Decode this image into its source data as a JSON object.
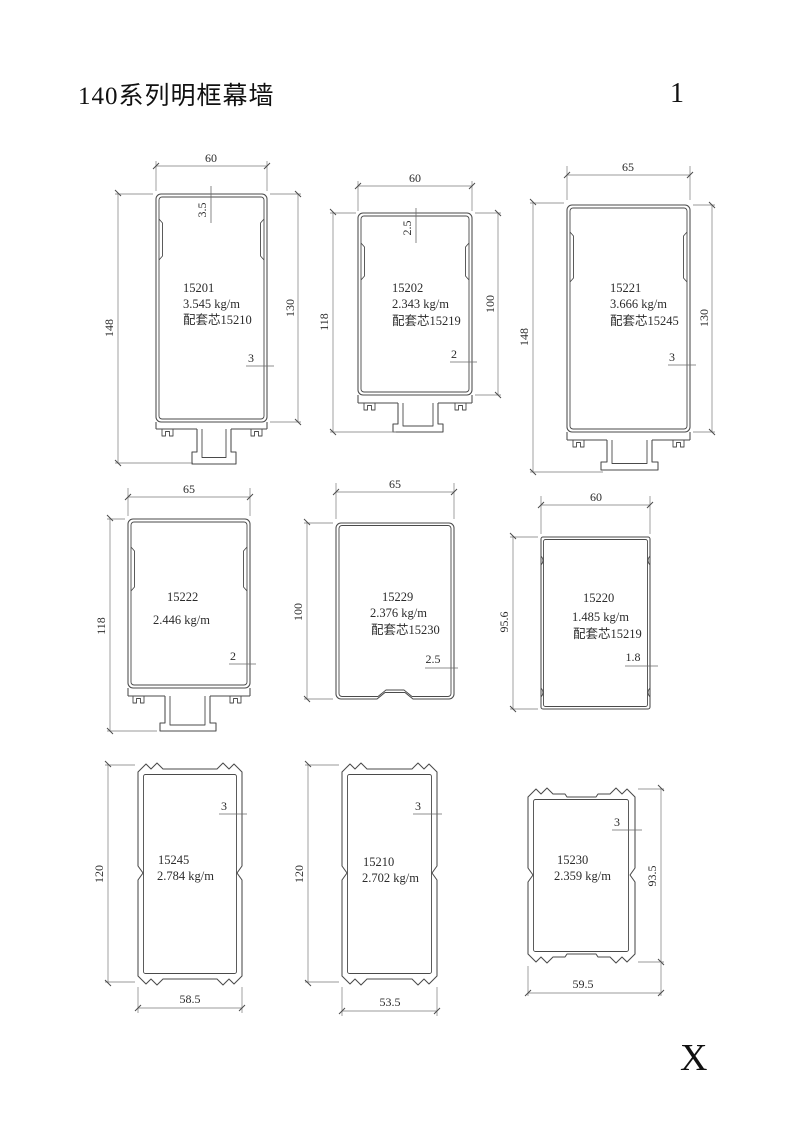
{
  "page": {
    "title": "140系列明框幕墙",
    "page_number": "1",
    "section_marker": "X"
  },
  "profiles": [
    {
      "id": "15201",
      "weight": "3.545 kg/m",
      "core": "配套芯15210",
      "width": "60",
      "height_total": "148",
      "height_body": "130",
      "wall_top": "3.5",
      "wall": "3"
    },
    {
      "id": "15202",
      "weight": "2.343 kg/m",
      "core": "配套芯15219",
      "width": "60",
      "height_total": "118",
      "height_body": "100",
      "wall_top": "2.5",
      "wall": "2"
    },
    {
      "id": "15221",
      "weight": "3.666 kg/m",
      "core": "配套芯15245",
      "width": "65",
      "height_total": "148",
      "height_body": "130",
      "wall": "3"
    },
    {
      "id": "15222",
      "weight": "2.446 kg/m",
      "width": "65",
      "height_total": "118",
      "wall": "2"
    },
    {
      "id": "15229",
      "weight": "2.376 kg/m",
      "core": "配套芯15230",
      "width": "65",
      "height": "100",
      "wall": "2.5"
    },
    {
      "id": "15220",
      "weight": "1.485 kg/m",
      "core": "配套芯15219",
      "width": "60",
      "height": "95.6",
      "wall": "1.8"
    },
    {
      "id": "15245",
      "weight": "2.784 kg/m",
      "height": "120",
      "width": "58.5",
      "wall": "3"
    },
    {
      "id": "15210",
      "weight": "2.702 kg/m",
      "height": "120",
      "width": "53.5",
      "wall": "3"
    },
    {
      "id": "15230",
      "weight": "2.359 kg/m",
      "height": "93.5",
      "width": "59.5",
      "wall": "3"
    }
  ]
}
